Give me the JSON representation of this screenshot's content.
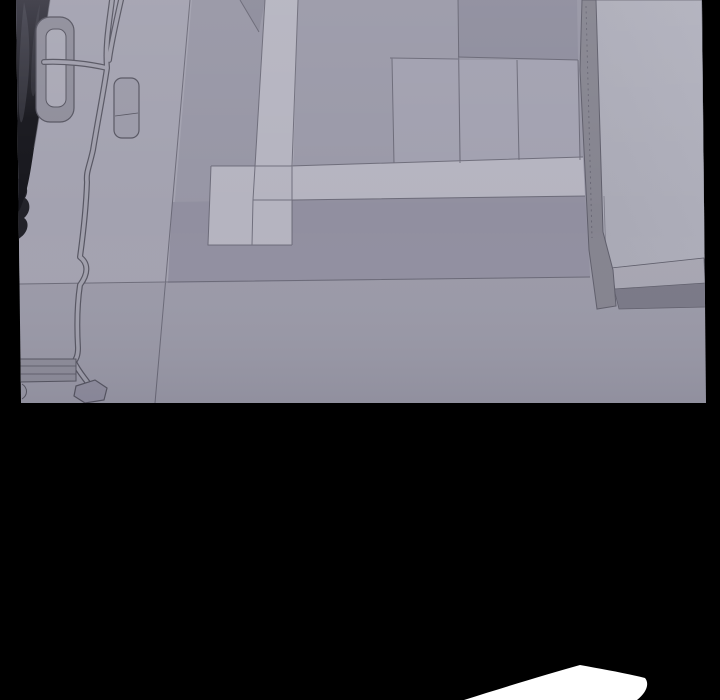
{
  "scene": {
    "kind": "comic-panel",
    "elements": {
      "panel": "overhead interior view of floor with geometric rug",
      "bed": "bed/mattress edge with stitched seam and frame rail, right side",
      "furniture": "dark furniture mass at top-left",
      "cord": "power cord loop, flat ribbon cable and plug blob on floor",
      "bubble": "white speech bubble tip at bottom edge"
    }
  },
  "colors": {
    "background": "#000000",
    "bubble": "#ffffff",
    "line": "#5f5e6b",
    "floorBase": "#9b9aa8",
    "floorLeft": "#a3a2b0",
    "rugField": "#9796a5",
    "wedgeDark": "#8d8c9b",
    "blockA": "#9a99a8",
    "blockB": "#a1a0af",
    "squareC": "#8e8d9d",
    "blockD": "#a2a1b0",
    "stripDark": "#918fa0",
    "bandLight": "#b5b4c0",
    "bedSurface": "#a8a8b4",
    "bedSurfaceLight": "#b1b1bd",
    "bedBand": "#85848f",
    "bedBase": "#a7a6b2",
    "bedRail": "#7a7987",
    "cordLine": "#575662",
    "cordFill": "#a09fac",
    "ringFill": "#8f8e9b",
    "ringInner": "#a9a8b5",
    "furnitureDark": "#17171d",
    "furnitureMid": "#3c3b46",
    "furnitureLight": "#6b6a76"
  }
}
